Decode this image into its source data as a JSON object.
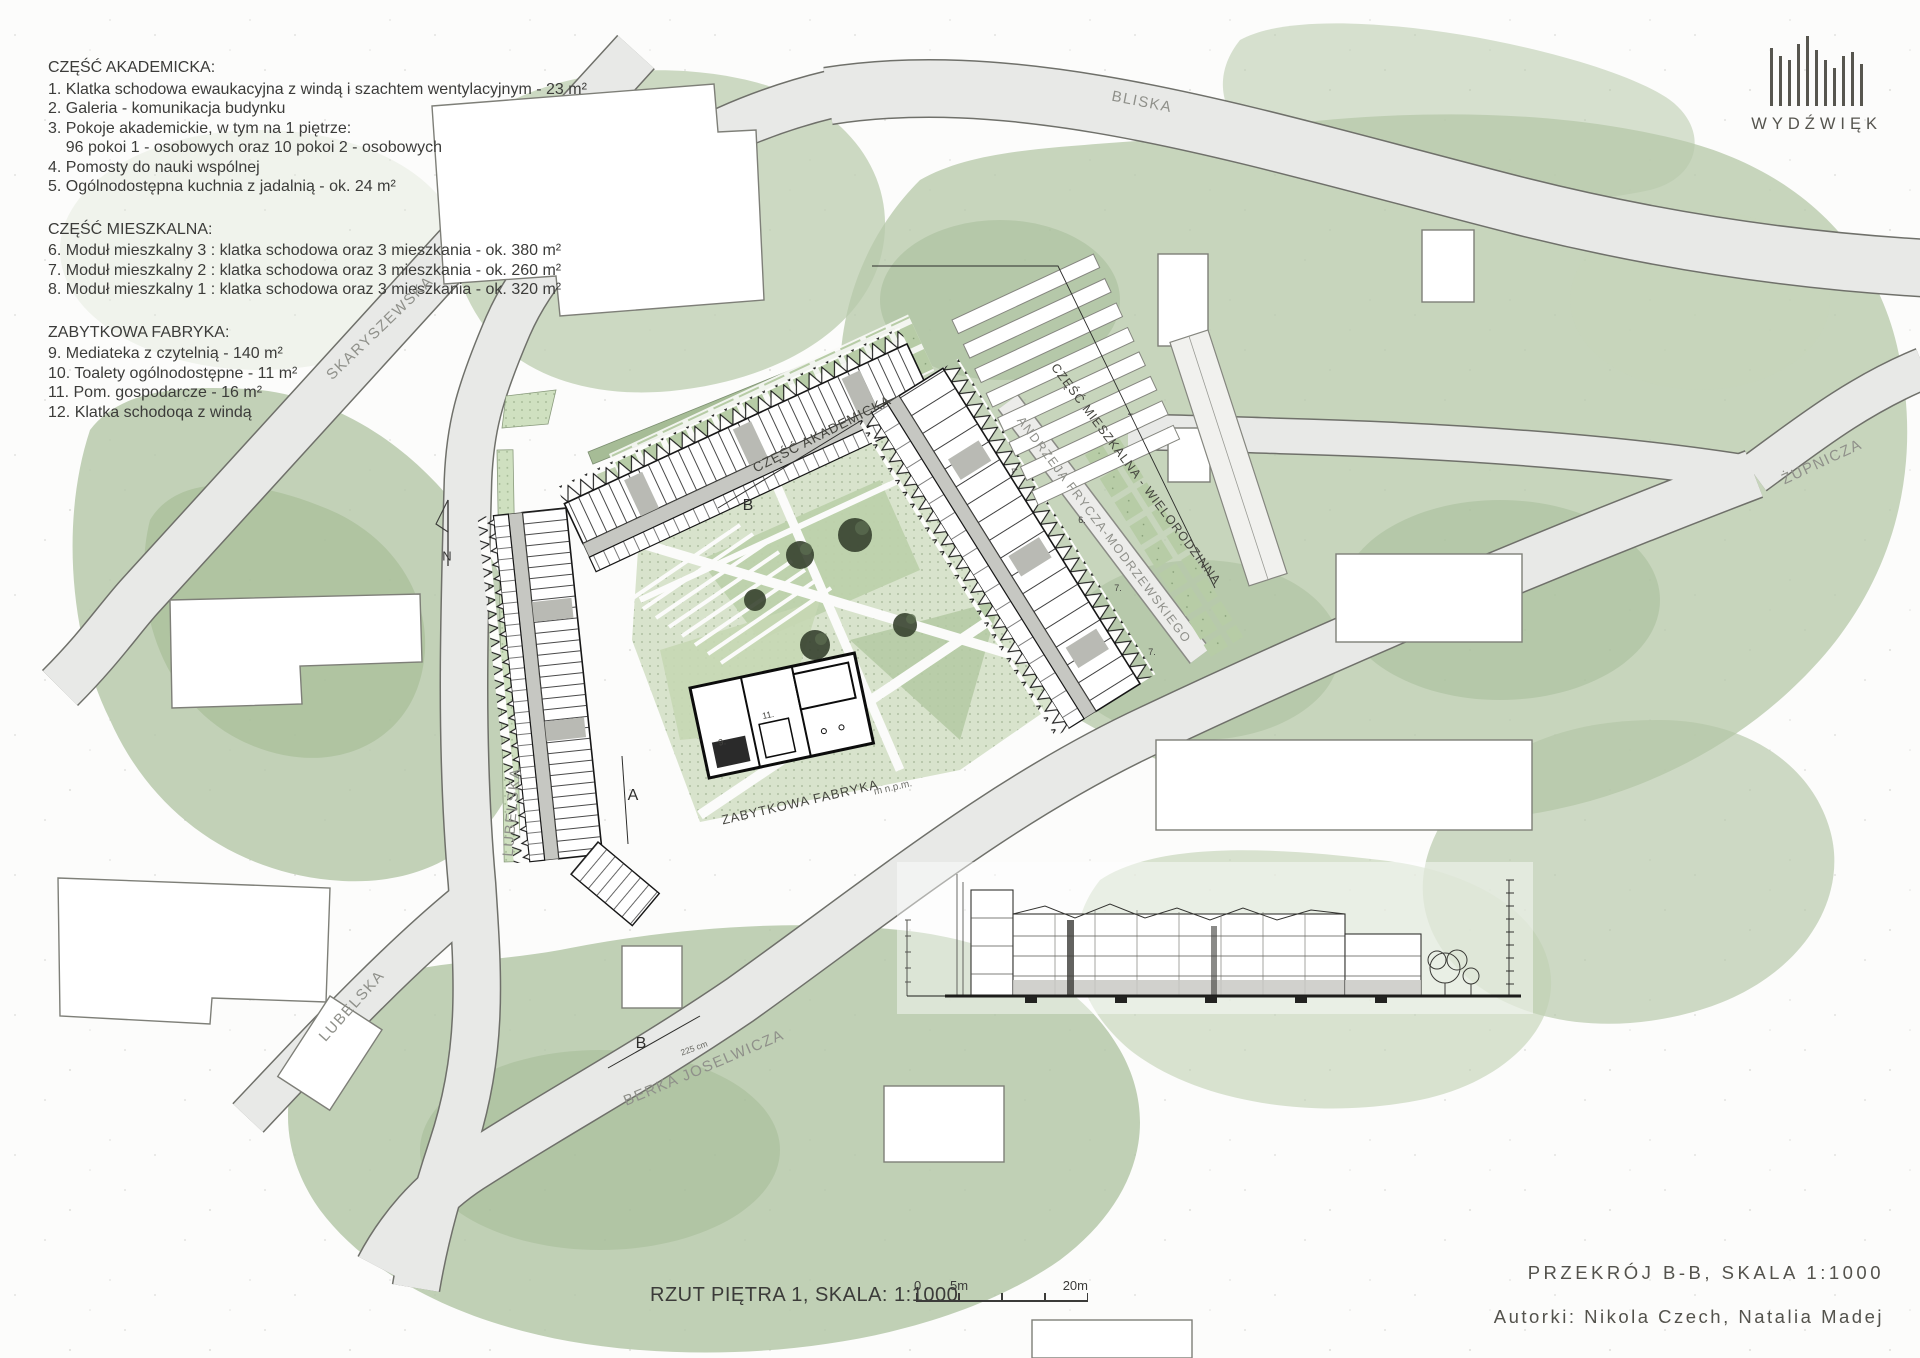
{
  "legend": {
    "sections": [
      {
        "title": "CZĘŚĆ AKADEMICKA:",
        "items": [
          "1. Klatka schodowa ewaukacyjna z windą i szachtem wentylacyjnym - 23 m²",
          "2. Galeria - komunikacja budynku",
          "3. Pokoje akademickie, w tym na 1 piętrze:",
          "    96 pokoi 1 - osobowych oraz 10 pokoi 2 - osobowych",
          "4. Pomosty do nauki wspólnej",
          "5. Ogólnodostępna kuchnia z jadalnią - ok. 24 m²"
        ]
      },
      {
        "title": "CZĘŚĆ MIESZKALNA:",
        "items": [
          "6. Moduł mieszkalny 3 : klatka schodowa oraz 3 mieszkania - ok. 380 m²",
          "7. Moduł mieszkalny 2 : klatka schodowa oraz 3 mieszkania - ok. 260 m²",
          "8. Moduł mieszkalny 1 : klatka schodowa oraz 3 mieszkania - ok. 320 m²"
        ]
      },
      {
        "title": "ZABYTKOWA FABRYKA:",
        "items": [
          "9. Mediateka z czytelnią - 140 m²",
          "10. Toalety ogólnodostępne - 11 m²",
          "11. Pom. gospodarcze - 16 m²",
          "12. Klatka schodoqa z windą"
        ]
      }
    ]
  },
  "logo": {
    "name": "WYDŹWIĘK"
  },
  "streets": {
    "bliska": "BLISKA",
    "zupnicza": "ŻUPNICZA",
    "skaryszewska": "SKARYSZEWSKA",
    "lubelska_upper": "LUBELSKA",
    "lubelska_lower": "LUBELSKA",
    "berka_joselwicza": "BERKA JOSELWICZA",
    "andrzeja": "ANDRZEJA FRYCZA-MODRZEWSKIEGO"
  },
  "plan_labels": {
    "academic_part": "CZĘŚĆ AKADEMICKA",
    "residential_part": "CZĘŚĆ MIESZKALNA - WIELORODZINNA",
    "factory": "ZABYTKOWA FABRYKA",
    "elevation": "m n.p.m.",
    "north": "N",
    "section_a": "A",
    "section_b_top": "B",
    "section_b_bottom": "B",
    "dim_225": "225 cm",
    "unit_4": "4",
    "unit_6": "6.",
    "unit_7a": "7.",
    "unit_7b": "7.",
    "unit_9": "9.",
    "unit_11": "11."
  },
  "footer": {
    "plan_title": "RZUT PIĘTRA 1, SKALA: 1:1000",
    "section_title": "PRZEKRÓJ B-B, SKALA 1:1000",
    "authors": "Autorki: Nikola Czech, Natalia Madej"
  },
  "scale_bar": {
    "zero": "0",
    "five": "5m",
    "twenty": "20m"
  },
  "colors": {
    "wash_green": "#b5c8aa",
    "wash_light": "#cdd9c2",
    "road_fill": "#e8e9e7",
    "road_edge": "#6f706a",
    "courtyard": "#d8e3cc",
    "ink": "#161616",
    "text": "#3c3c3a"
  }
}
